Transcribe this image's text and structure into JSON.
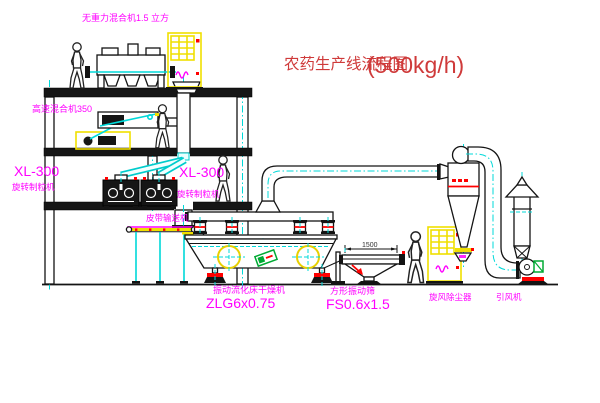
{
  "diagram": {
    "title": "农药生产线流程图",
    "capacity": "(500kg/h)"
  },
  "labels": {
    "gravity_mixer": "无重力混合机1.5 立方",
    "high_speed_mixer": "高速混合机350",
    "granulator_left_model": "XL-300",
    "granulator_left_name": "旋转制粒机",
    "granulator_right_model": "XL-300",
    "granulator_right_name": "旋转制粒机",
    "belt_conveyor": "皮带输送机",
    "dryer_name": "振动流化床干燥机",
    "dryer_model": "ZLG6x0.75",
    "screen_name": "方形振动筛",
    "screen_model": "FS0.6x1.5",
    "cyclone_name": "旋风除尘器",
    "fan_name": "引风机",
    "screen_dimension": "1500"
  },
  "colors": {
    "background": "#ffffff",
    "line_black": "#141414",
    "label_magenta": "#ff00ff",
    "title_red": "#cf3a3a",
    "centerline_cyan": "#00d9d9",
    "cabinet_yellow": "#f0df00",
    "accent_red": "#ff0000",
    "motor_green": "#00aa33"
  }
}
